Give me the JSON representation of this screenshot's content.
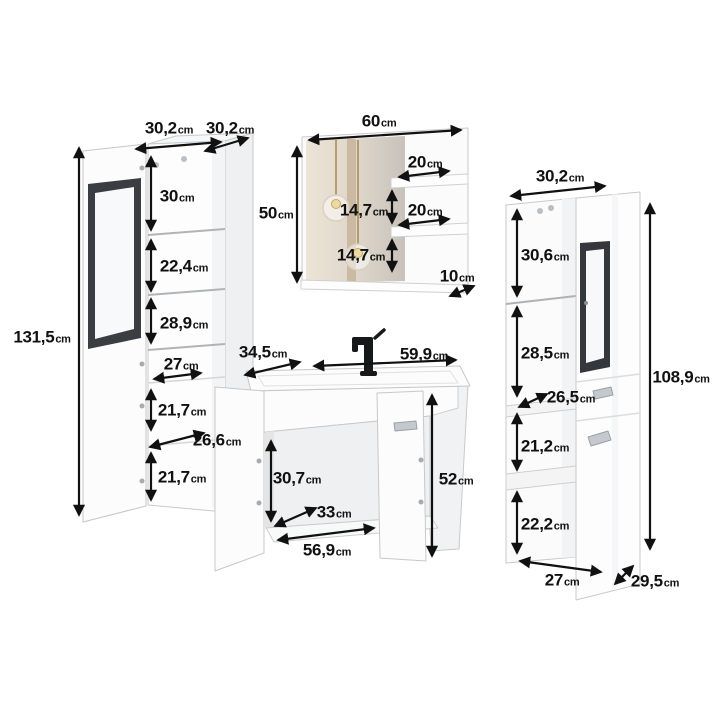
{
  "unit_suffix": "cm",
  "left_cabinet": {
    "door_width": "30,2",
    "depth": "30,2",
    "height": "131,5",
    "section_1": "30",
    "section_2": "22,4",
    "section_3": "28,9",
    "inner_width": "27",
    "section_4": "21,7",
    "shelf_depth": "26,6",
    "section_5": "21,7"
  },
  "mirror": {
    "width": "60",
    "height": "50",
    "shelf_top_width": "20",
    "gap_top": "14,7",
    "shelf_mid_width": "20",
    "gap_bottom": "14,7",
    "depth": "10"
  },
  "vanity": {
    "depth": "34,5",
    "width": "59,9",
    "height": "52",
    "inner_height": "30,7",
    "inner_depth": "33",
    "inner_width": "56,9"
  },
  "right_cabinet": {
    "width": "30,2",
    "section_1": "30,6",
    "section_2": "28,5",
    "shelf_depth": "26,5",
    "section_3": "21,2",
    "section_4": "22,2",
    "bottom_width": "27",
    "depth": "29,5",
    "height": "108,9"
  }
}
